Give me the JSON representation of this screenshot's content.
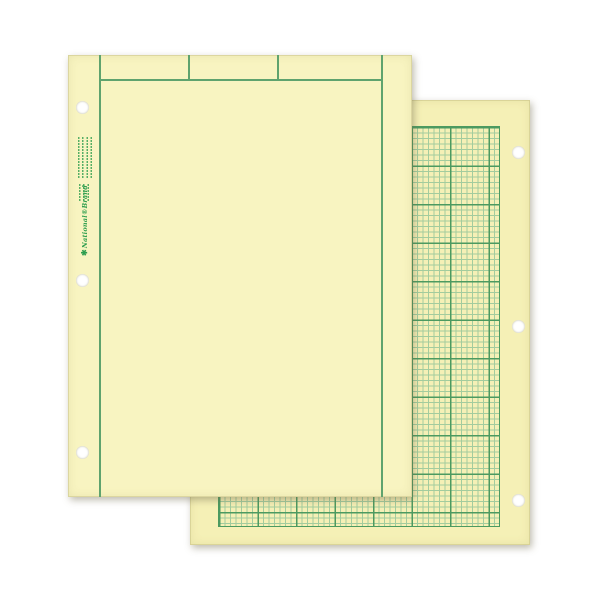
{
  "scene": {
    "description": "Two overlapping sheets of green-tint computation pad paper on a white background: a plain front sheet with three header boxes, vertical margin lines and three left punch holes, over a quadrille-grid back sheet with three right punch holes."
  },
  "logo": {
    "star_icon": "✱",
    "text": "National®Brand"
  },
  "colors": {
    "background": "#ffffff",
    "paper_front": "#f8f4c1",
    "paper_back": "#f5f0b6",
    "line_green": "#5fa36e",
    "grid_heavy": "#4c9a60",
    "grid_fine": "#a3cc9e",
    "print_green": "#2f9e4f",
    "hole_white": "#ffffff"
  }
}
